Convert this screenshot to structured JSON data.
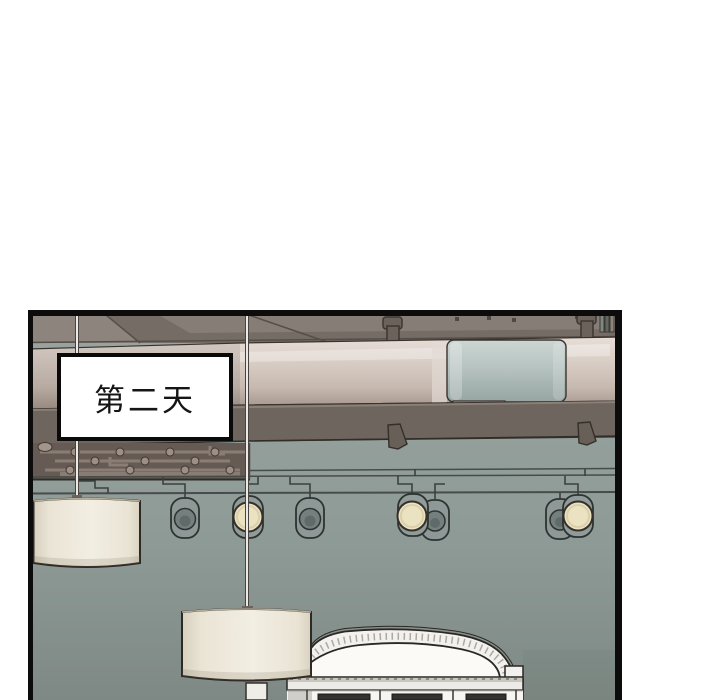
{
  "page": {
    "background_color": "#ffffff"
  },
  "panel": {
    "caption_box": {
      "text": "第二天"
    },
    "border_color": "#0c0c0c",
    "scene": {
      "setting": "interior ceiling with large pipe, track spotlights, pendant drum lamps and white arched cabinet",
      "pendant_lamp_count": 2,
      "spotlight_count": 7,
      "lit_spotlight_count": 3,
      "colors": {
        "wall_top": "#9aa5a2",
        "wall_bottom": "#7e8985",
        "ceiling": "#7b726d",
        "main_pipe": "#d6cbc3",
        "pipe_sleeve": "#b7c3c0",
        "support_beam": "#6e655f",
        "pipe_recess": "#665b54",
        "lamp_shade": "#efebdf",
        "bulb_glow": "#ebe2c2",
        "cabinet_white": "#f3f2ee"
      }
    }
  }
}
